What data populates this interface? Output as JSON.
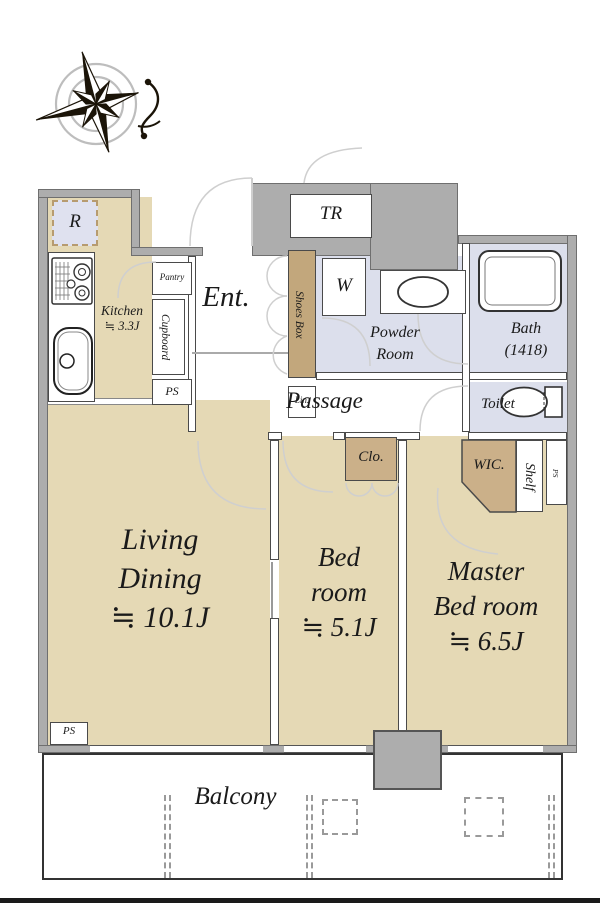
{
  "labels": {
    "kitchen": {
      "name": "Kitchen",
      "size": "≒ 3.3J"
    },
    "ent": "Ent.",
    "passage": "Passage",
    "living": {
      "l1": "Living",
      "l2": "Dining",
      "size": "≒ 10.1J"
    },
    "bedroom": {
      "l1": "Bed",
      "l2": "room",
      "size": "≒ 5.1J"
    },
    "master": {
      "l1": "Master",
      "l2": "Bed room",
      "size": "≒ 6.5J"
    },
    "balcony": "Balcony",
    "powder": {
      "l1": "Powder",
      "l2": "Room"
    },
    "bath": {
      "l1": "Bath",
      "l2": "(1418)"
    },
    "toilet": "Toilet",
    "tr": "TR",
    "w": "W",
    "r": "R",
    "pantry": "Pantry",
    "cupboard": "Cupboard",
    "shoes_box": "Shoes Box",
    "lin": "Lin.",
    "clo": "Clo.",
    "wic": "WIC.",
    "shelf": "Shelf",
    "ps_kitchen": "PS",
    "ps_living": "PS",
    "ps_right": "PS"
  },
  "colors": {
    "floor_tan": "#E5D9B5",
    "floor_lavender": "#DCDFEC",
    "wall_gray": "#ADADAD",
    "closet_tan": "#CBB089",
    "shoes_box_tan": "#C2A77C",
    "r_box_fill": "#DFE1EF",
    "r_box_dash": "#B79B6F",
    "outline": "#4A4A4A",
    "arc_gray": "#CFCFCF"
  }
}
